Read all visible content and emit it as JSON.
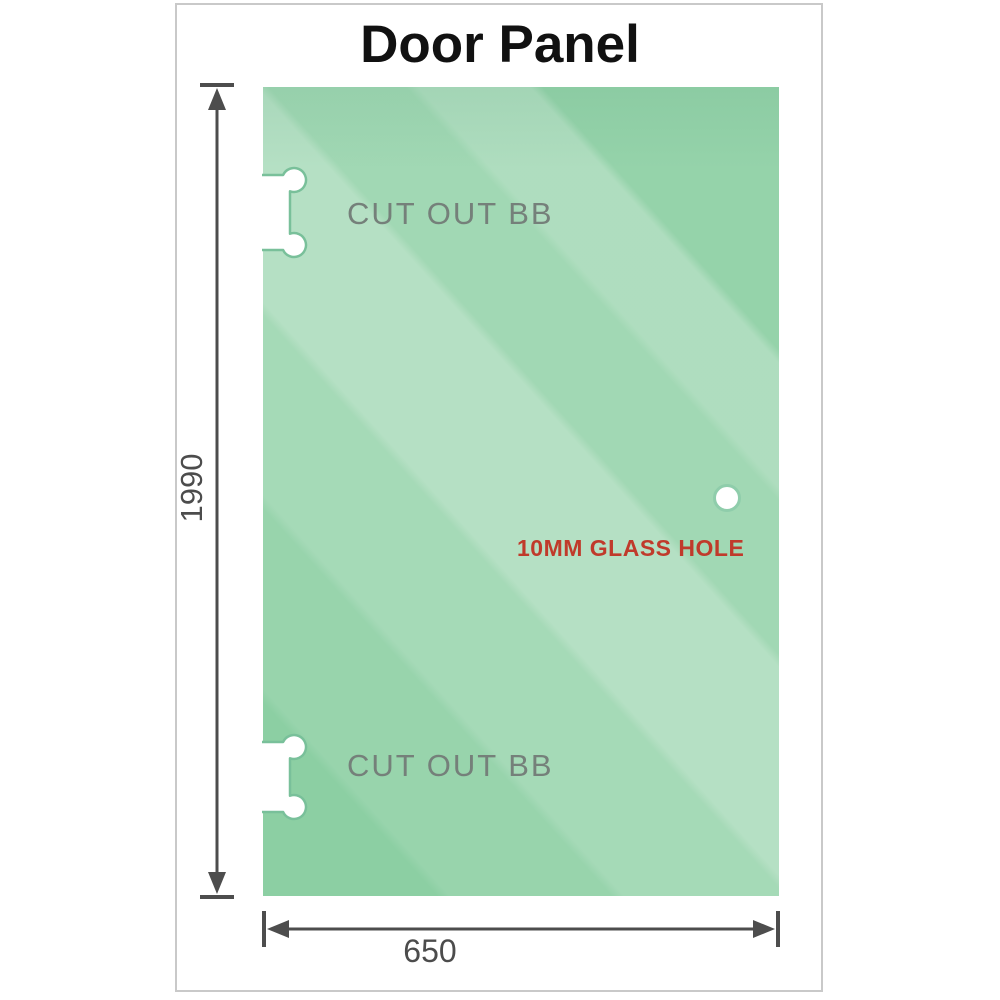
{
  "title": "Door Panel",
  "panel": {
    "cutout_top_label": "CUT OUT BB",
    "cutout_bottom_label": "CUT OUT BB",
    "hole_label": "10MM GLASS HOLE"
  },
  "dimensions": {
    "height_label": "1990",
    "width_label": "650"
  },
  "colors": {
    "title_black": "#111111",
    "frame_gray": "#c9c9c9",
    "glass_green": "#8ccfa3",
    "glass_highlight": "#d3efdd",
    "cutout_stroke_green": "#79c09a",
    "hole_ring_green": "#8fcdab",
    "cutout_label_gray": "#75807a",
    "hole_label_red": "#c03a2b",
    "dimension_gray": "#4d4d4d",
    "dimension_text_gray": "#4c4c4c"
  }
}
